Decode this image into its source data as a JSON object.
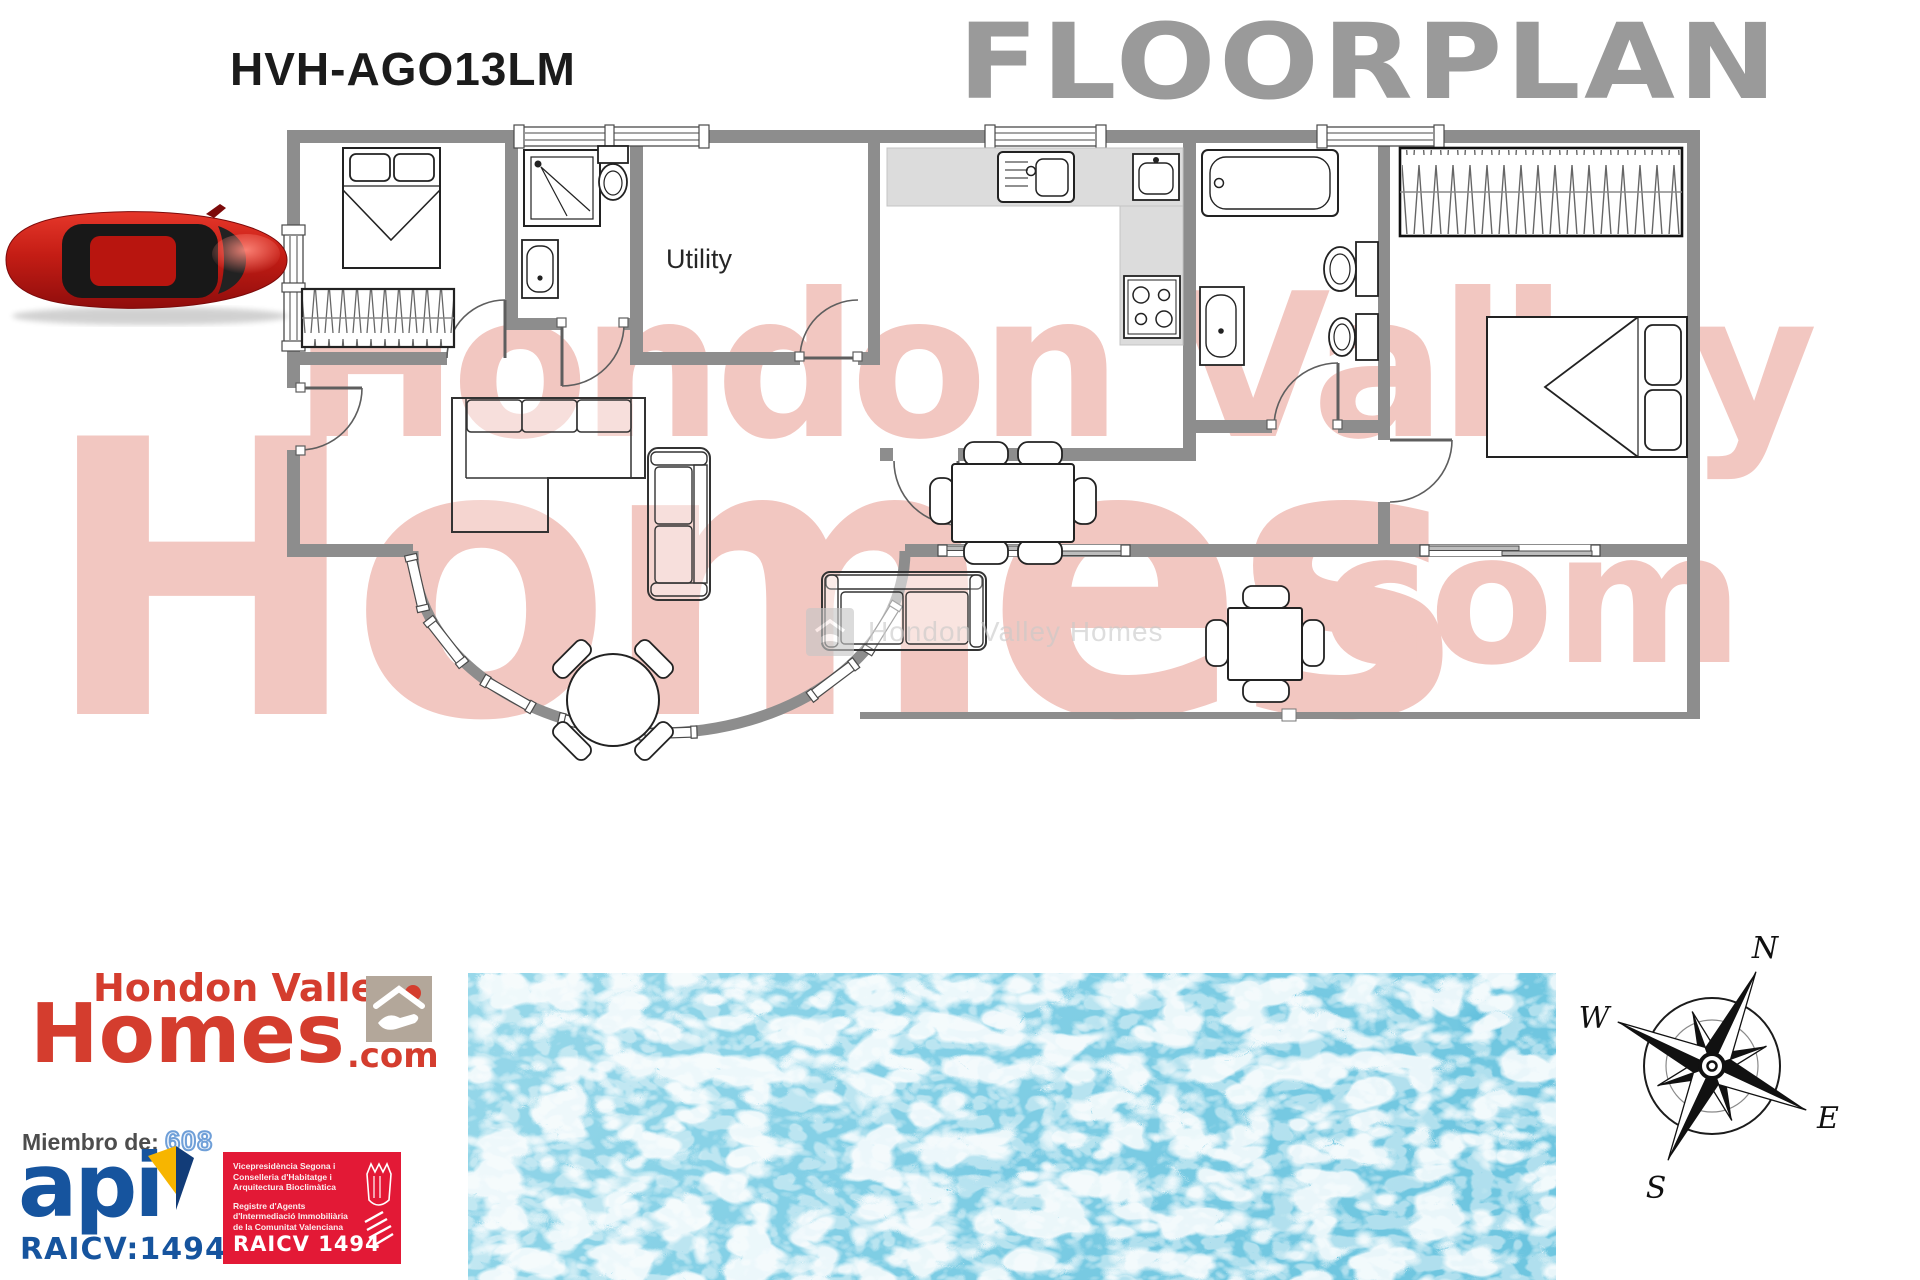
{
  "header": {
    "reference": "HVH-AGO13LM",
    "title": "FLOORPLAN"
  },
  "plan": {
    "labels": {
      "utility": "Utility"
    }
  },
  "watermark": {
    "line1": "Hondon Valley",
    "line2": "Homes",
    "suffix": ".com",
    "center": "Hondon Valley Homes"
  },
  "branding": {
    "logo_top": "Hondon Valley",
    "logo_main": "Homes",
    "logo_suffix": ".com",
    "membership_label": "Miembro de:",
    "membership_number": "608",
    "api_text": "api",
    "raicv_text": "RAICV:1494",
    "badge": {
      "lines": [
        "Vicepresidència Segona i",
        "Conselleria d'Habitatge i",
        "Arquitectura Bioclimàtica",
        "Registre d'Agents",
        "d'Intermediació Immobiliària",
        "de la Comunitat Valenciana"
      ],
      "code": "RAICV 1494"
    }
  },
  "compass": {
    "n": "N",
    "e": "E",
    "s": "S",
    "w": "W"
  },
  "colors": {
    "accent_red": "#d43d2e",
    "api_blue": "#16549e",
    "badge_red": "#e31936",
    "wall_gray": "#8d8d8d",
    "floorplan_gray": "#9a9a9a",
    "watermark_pink": "#f2c7c1",
    "pool_blue": "#6cc4e0"
  }
}
